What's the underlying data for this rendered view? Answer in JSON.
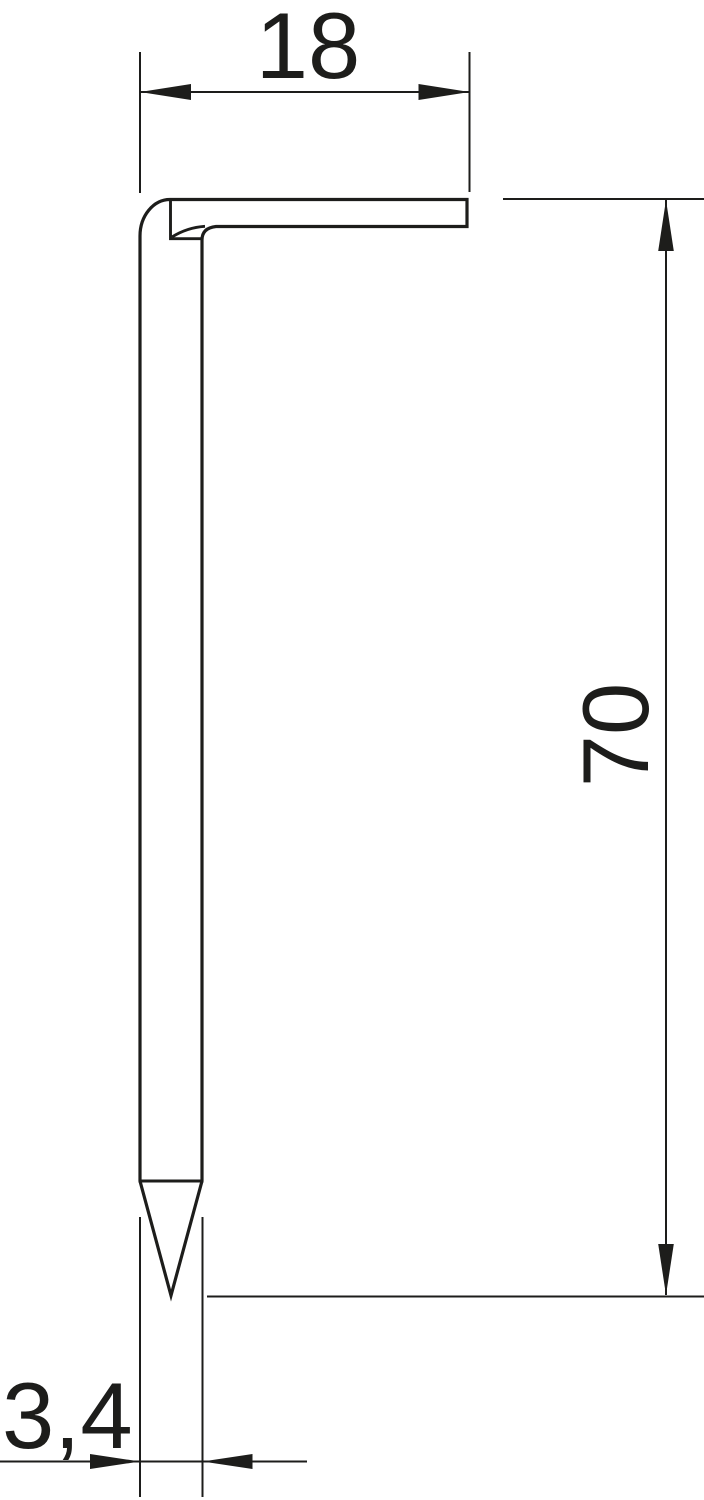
{
  "canvas": {
    "width": 704,
    "height": 1500,
    "background_color": "#ffffff",
    "line_color": "#1d1d1b"
  },
  "figure": {
    "shape_name": "hook-nail-profile",
    "features": [
      "flattened-bent-head",
      "straight-shank",
      "pointed-tip"
    ]
  },
  "dimensions": {
    "head_length": {
      "label": "18",
      "orientation": "horizontal",
      "position": "top"
    },
    "shank_length": {
      "label": "70",
      "orientation": "vertical",
      "position": "right"
    },
    "shank_diameter": {
      "label": "3,4",
      "orientation": "horizontal",
      "position": "bottom-left"
    }
  }
}
